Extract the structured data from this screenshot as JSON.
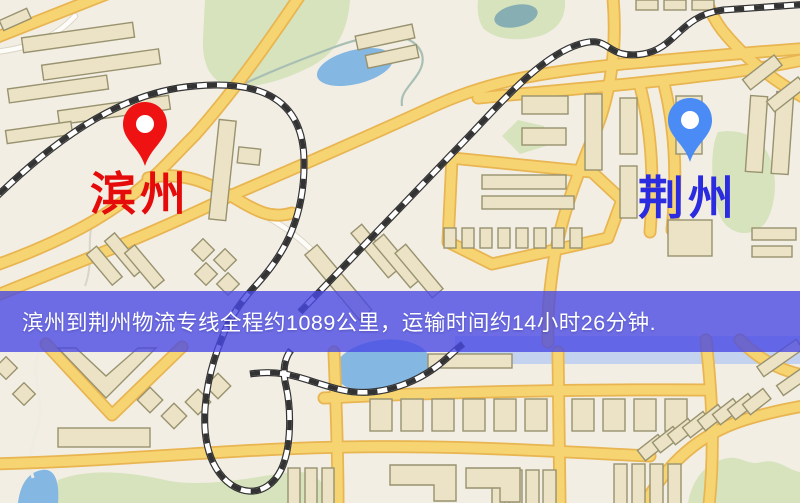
{
  "banner": {
    "text": "滨州到荆州物流专线全程约1089公里，运输时间约14小时26分钟."
  },
  "route": {
    "origin": "滨州",
    "destination": "荆州",
    "distance": "约1089公里",
    "duration": "约14小时26分钟"
  },
  "markers": {
    "origin": {
      "label": "滨州",
      "pin_color": "#ee1212",
      "label_color": "#e60b0b"
    },
    "destination": {
      "label": "荆州",
      "pin_color": "#4b8bf5",
      "label_color": "#2b2be0"
    }
  },
  "theme": {
    "banner_background": "rgba(72,72,228,0.78)",
    "banner_text_color": "#ffffff",
    "map_background": "#f2eee4",
    "road_fill": "#f7d472",
    "road_casing": "#e8b551",
    "building_fill": "#ece3c6",
    "building_stroke": "#98926f",
    "park_green": "#d6e3bc",
    "water_blue": "#84b7e2",
    "railway": "#333333"
  }
}
